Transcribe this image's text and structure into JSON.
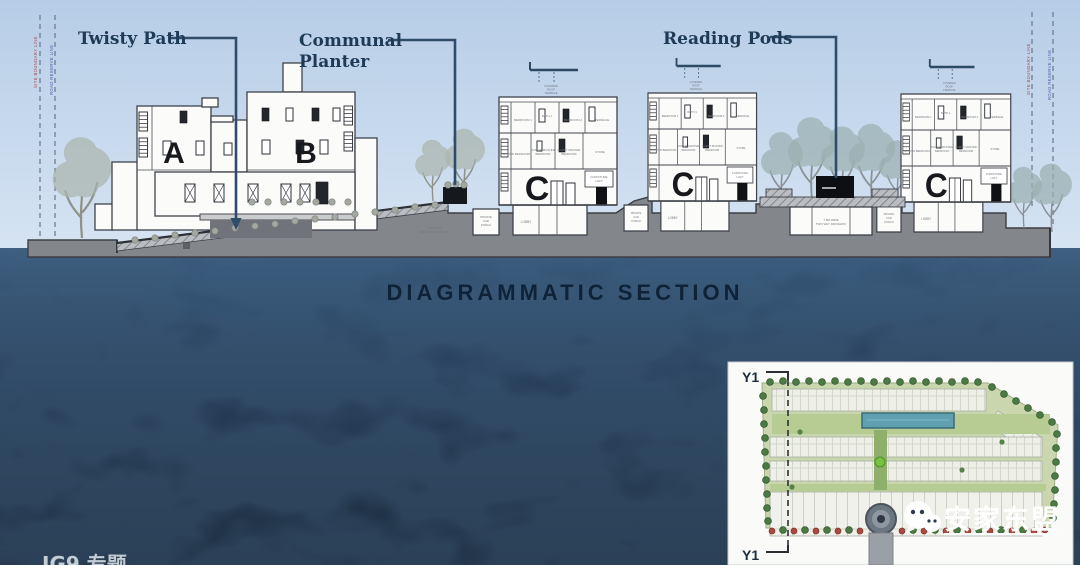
{
  "title": {
    "text": "DIAGRAMMATIC SECTION"
  },
  "annotations": {
    "twisty_path": "Twisty Path",
    "communal_planter": {
      "l1": "Communal",
      "l2": "Planter"
    },
    "reading_pods": "Reading Pods"
  },
  "buildings": {
    "a": "A",
    "b": "B",
    "c": "C"
  },
  "room_labels": {
    "covered_roof": {
      "l1": "COVERED",
      "l2": "ROOF",
      "l3": "TERRACE"
    },
    "bedroom1": "BEDROOM 1",
    "bath": "BATH 1",
    "bedroom2": "BEDROOM 2",
    "terrace": "TERRACE",
    "master": "MASTER BEDROOM",
    "junior": {
      "l1": "JUNIOR MASTER",
      "l2": "BEDROOM"
    },
    "guest": {
      "l1": "GUEST MASTER",
      "l2": "BEDROOM"
    },
    "store": "STORE",
    "furniture": {
      "l1": "FURNITURE",
      "l2": "LOFT"
    },
    "lobby": "LOBBY",
    "car_porch": {
      "l1": "PRIVATE",
      "l2": "CAR",
      "l3": "PORCH"
    },
    "driveway": {
      "l1": "7.5M WIDE",
      "l2": "TWO WAY DRIVEWAY"
    }
  },
  "boundary": {
    "left_red": "SITE BOUNDARY LINE",
    "left_blue": "ROAD RESERVE LINE",
    "right_red": "SITE BOUNDARY LINE",
    "right_blue": "ROAD RESERVE LINE"
  },
  "inset": {
    "section_marker_top": "Y1",
    "section_marker_bottom": "Y1"
  },
  "watermarks": {
    "wechat_name": "安家东盟",
    "bottom_left_partial": "JG9 专题"
  },
  "colors": {
    "sky_top": "#b7cde7",
    "sky_bottom": "#d6e4f3",
    "ground_gray": "#83868b",
    "navy_background": "#0c1930",
    "annotation_navy": "#1d3a57",
    "title_navy": "#0c1f33",
    "watermark_white": "#ffffff"
  }
}
